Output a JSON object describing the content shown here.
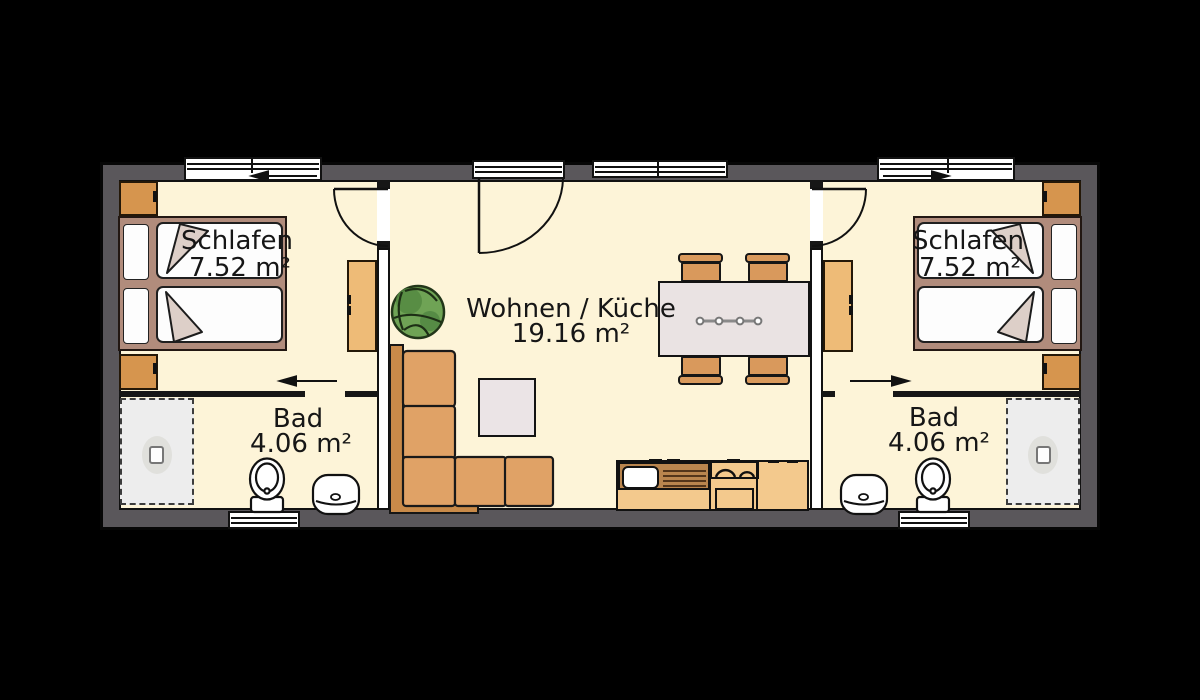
{
  "type": "floor-plan",
  "rooms": {
    "bedroom_left": {
      "label": "Schlafen",
      "area": "7.52 m²"
    },
    "bath_left": {
      "label": "Bad",
      "area": "4.06 m²"
    },
    "living_kitchen": {
      "label": "Wohnen / Küche",
      "area": "19.16 m²"
    },
    "bedroom_right": {
      "label": "Schlafen",
      "area": "7.52 m²"
    },
    "bath_right": {
      "label": "Bad",
      "area": "4.06 m²"
    }
  },
  "colors": {
    "background": "#000000",
    "wall": "#5a575b",
    "line": "#111111",
    "floor": "#fdf4d8",
    "bed_frame": "#b18c7c",
    "mattress": "#fdfdfd",
    "blanket": "#ddcfc8",
    "wardrobe": "#d6954e",
    "dresser": "#eebb77",
    "sofa_back": "#c98a49",
    "sofa_seat": "#e0a266",
    "chair": "#d9995c",
    "table": "#eae3e3",
    "coffee_table": "#ebe4e6",
    "kitchen": "#f3c98d",
    "kitchen_dark": "#b9854e",
    "shower": "#ededed",
    "plant": "#6fa355"
  },
  "symbols": [
    "double-bed",
    "pillow",
    "mattress",
    "wardrobe",
    "dresser",
    "corner-sofa",
    "coffee-table",
    "dining-table",
    "chair",
    "table-centerpiece",
    "kitchen-counter",
    "sink",
    "drainer",
    "cooktop",
    "oven",
    "toilet",
    "washbasin",
    "shower",
    "floor-drain",
    "plant",
    "door-swing",
    "sliding-door-arrow",
    "window"
  ]
}
